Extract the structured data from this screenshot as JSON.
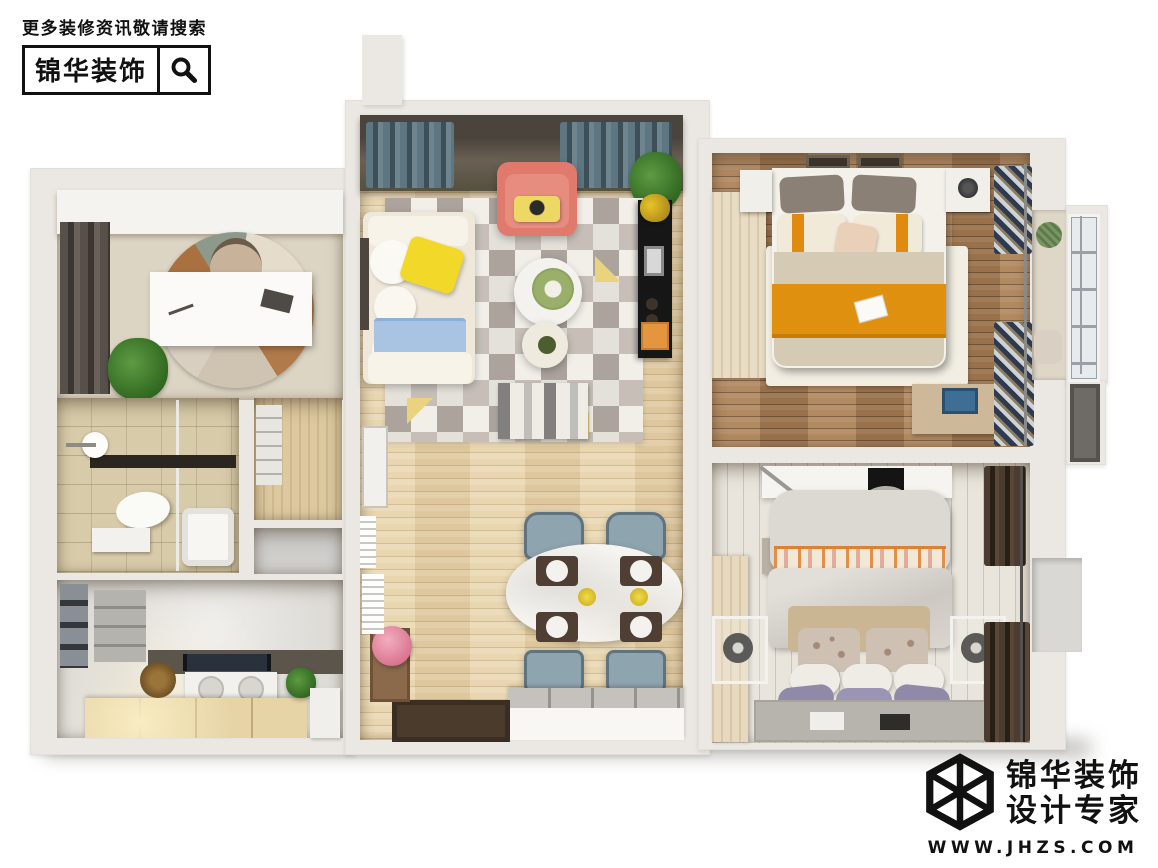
{
  "brand_header": {
    "tagline": "更多装修资讯敬请搜索",
    "brand_name": "锦华装饰",
    "search_icon": "magnifier-icon"
  },
  "brand_footer": {
    "logo_icon": "wireframe-cube-icon",
    "brand_name": "锦华装饰",
    "subtitle": "设计专家",
    "website": "WWW.JHZS.COM"
  },
  "palette": {
    "background": "#ffffff",
    "wall": "#ebe8e3",
    "wood_light_oak": "#e7d2a7",
    "wood_medium": "#ac8157",
    "wood_whitewash": "#e9e5dc",
    "tile_beige": "#d8cba9",
    "marble_gray": "#dedcd7",
    "accent_coral": "#e07a6c",
    "accent_yellow": "#f0d832",
    "accent_orange": "#e0900f",
    "accent_teal_curtain": "#5d7682",
    "accent_blue_blanket": "#a9c3e2",
    "accent_purple_pillow": "#8f8aa8",
    "rug_gray": "#c6beb7",
    "text_black": "#111111"
  }
}
